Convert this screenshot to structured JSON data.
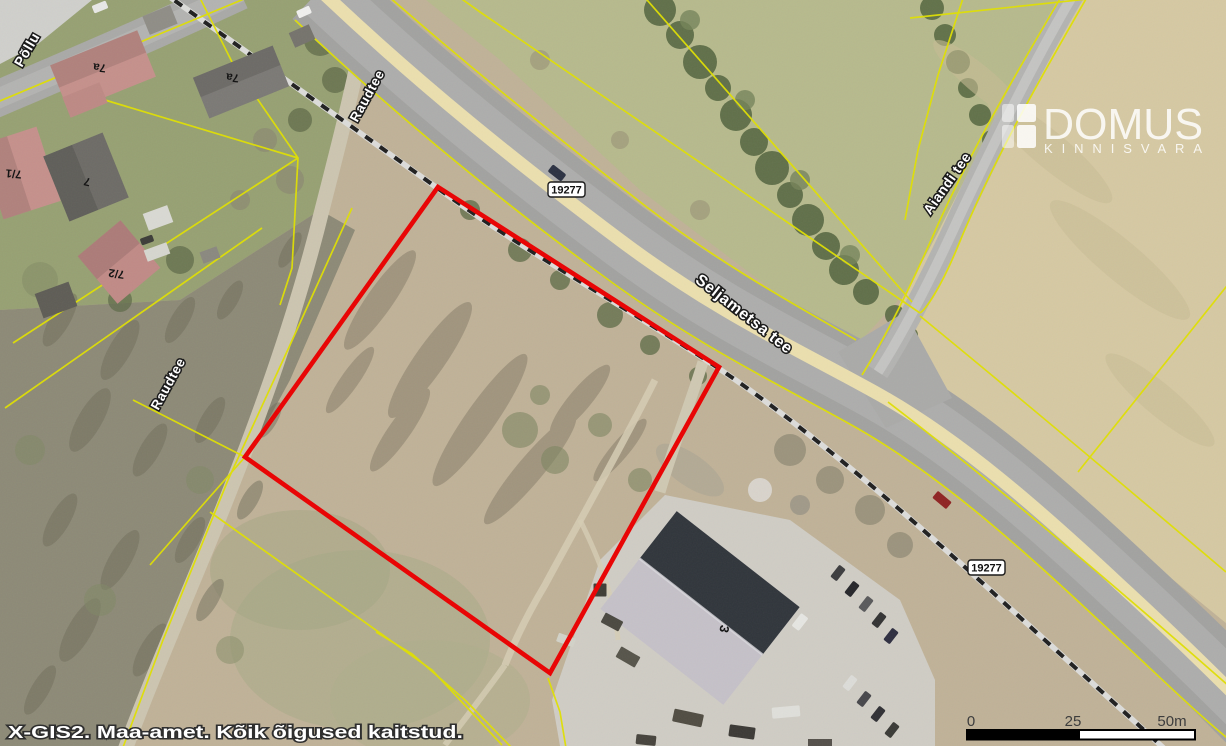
{
  "attribution": {
    "text": "X-GIS2. Maa-amet. Kõik õigused kaitstud."
  },
  "watermark": {
    "brand": "DOMUS",
    "tagline": "KINNISVARA"
  },
  "labels": {
    "streets": [
      {
        "id": "pollu",
        "text": "Põllu"
      },
      {
        "id": "raudtee-upper",
        "text": "Raudtee"
      },
      {
        "id": "raudtee-lower",
        "text": "Raudtee"
      },
      {
        "id": "seljametsa-tee",
        "text": "Seljametsa tee"
      },
      {
        "id": "aiandi-tee",
        "text": "Aiandi tee"
      }
    ],
    "road_numbers": [
      {
        "text": "19277"
      },
      {
        "text": "19277"
      }
    ],
    "house_numbers": [
      {
        "text": "7a"
      },
      {
        "text": "7a"
      },
      {
        "text": "7/1"
      },
      {
        "text": "7"
      },
      {
        "text": "7/2"
      },
      {
        "text": "3"
      }
    ]
  },
  "scale_bar": {
    "tick_start": "0",
    "tick_mid": "25",
    "tick_end": "50m"
  },
  "colors": {
    "parcel_outline": "#ea0000",
    "cadastral_line": "#e0e000",
    "road_median": "#ebdfae",
    "asphalt": "#a2a2a0"
  }
}
